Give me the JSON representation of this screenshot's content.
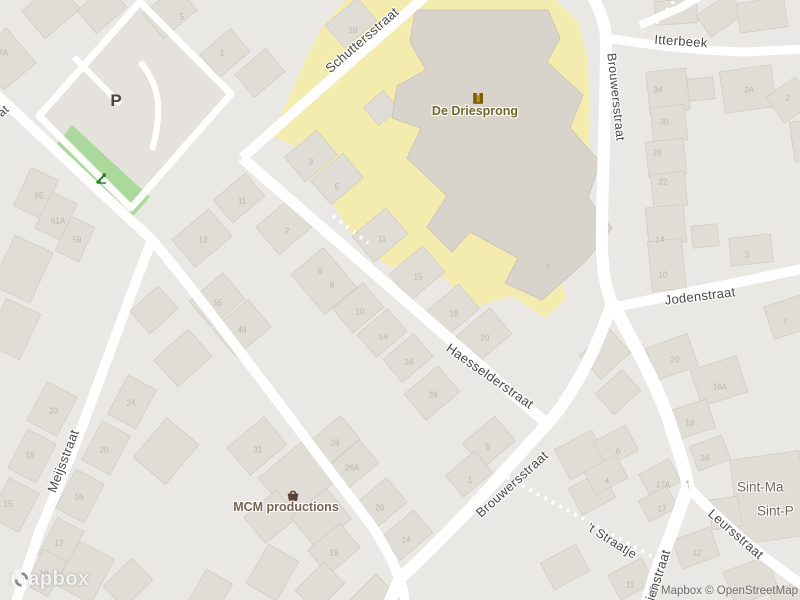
{
  "map": {
    "street_labels": [
      {
        "text": "Schuttersstraat",
        "x": 362,
        "y": 40,
        "rot": -41,
        "size": 13
      },
      {
        "text": "Itterbeek",
        "x": 681,
        "y": 41,
        "rot": 4,
        "size": 13
      },
      {
        "text": "Brouwersstraat",
        "x": 616,
        "y": 97,
        "rot": 84,
        "size": 12.5
      },
      {
        "text": "Jodenstraat",
        "x": 700,
        "y": 296,
        "rot": -7,
        "size": 13
      },
      {
        "text": "Haesselderstraat",
        "x": 490,
        "y": 376,
        "rot": 35,
        "size": 13
      },
      {
        "text": "Meijsstraat",
        "x": 63,
        "y": 461,
        "rot": -69,
        "size": 13
      },
      {
        "text": "Brouwersstraat",
        "x": 512,
        "y": 484,
        "rot": -42,
        "size": 13
      },
      {
        "text": "'t Straatje",
        "x": 612,
        "y": 541,
        "rot": 32,
        "size": 12.5
      },
      {
        "text": "Leursstraat",
        "x": 736,
        "y": 534,
        "rot": 41,
        "size": 13
      },
      {
        "text": "ienstraat",
        "x": 658,
        "y": 575,
        "rot": -72,
        "size": 13
      },
      {
        "text": "at",
        "x": 3,
        "y": 111,
        "rot": -43,
        "size": 12
      }
    ],
    "place_labels": [
      {
        "text": "Sint-Ma",
        "x": 737,
        "y": 487
      },
      {
        "text": "Sint-P",
        "x": 757,
        "y": 511
      }
    ],
    "pois": {
      "driesprong": {
        "name": "De Driesprong",
        "label_x": 475,
        "label_y": 111,
        "icon": "school-icon",
        "icon_x": 472,
        "icon_y": 92
      },
      "mcm": {
        "name": "MCM productions",
        "label_x": 286,
        "label_y": 507,
        "icon": "shopping-basket-icon",
        "icon_x": 286,
        "icon_y": 489
      },
      "parking": {
        "label": "P",
        "x": 116,
        "y": 101
      },
      "playground": {
        "icon": "playground-icon",
        "x": 95,
        "y": 172
      }
    },
    "oneway": {
      "glyph": "↑",
      "x": 688,
      "y": 484
    },
    "house_numbers": [
      {
        "t": "5",
        "x": 182,
        "y": 17
      },
      {
        "t": "1",
        "x": 222,
        "y": 53
      },
      {
        "t": "7A",
        "x": 3,
        "y": 53
      },
      {
        "t": "10",
        "x": 353,
        "y": 30
      },
      {
        "t": "3",
        "x": 311,
        "y": 162
      },
      {
        "t": "5",
        "x": 337,
        "y": 187
      },
      {
        "t": "2",
        "x": 287,
        "y": 231
      },
      {
        "t": "11",
        "x": 242,
        "y": 201
      },
      {
        "t": "13",
        "x": 203,
        "y": 240
      },
      {
        "t": "65",
        "x": 39,
        "y": 196
      },
      {
        "t": "61A",
        "x": 58,
        "y": 221
      },
      {
        "t": "59",
        "x": 77,
        "y": 240
      },
      {
        "t": "11",
        "x": 382,
        "y": 239
      },
      {
        "t": "15",
        "x": 418,
        "y": 277
      },
      {
        "t": "6",
        "x": 320,
        "y": 271
      },
      {
        "t": "8",
        "x": 332,
        "y": 285
      },
      {
        "t": "10",
        "x": 360,
        "y": 312
      },
      {
        "t": "14",
        "x": 383,
        "y": 337
      },
      {
        "t": "16",
        "x": 409,
        "y": 362
      },
      {
        "t": "20",
        "x": 485,
        "y": 338
      },
      {
        "t": "19",
        "x": 454,
        "y": 314
      },
      {
        "t": "39",
        "x": 433,
        "y": 395
      },
      {
        "t": "55",
        "x": 218,
        "y": 303
      },
      {
        "t": "49",
        "x": 242,
        "y": 330
      },
      {
        "t": "23",
        "x": 54,
        "y": 411
      },
      {
        "t": "19",
        "x": 30,
        "y": 455
      },
      {
        "t": "15",
        "x": 8,
        "y": 504
      },
      {
        "t": "24",
        "x": 131,
        "y": 403
      },
      {
        "t": "20",
        "x": 104,
        "y": 450
      },
      {
        "t": "16",
        "x": 79,
        "y": 497
      },
      {
        "t": "12",
        "x": 59,
        "y": 543
      },
      {
        "t": "10",
        "x": 44,
        "y": 574
      },
      {
        "t": "31",
        "x": 258,
        "y": 450
      },
      {
        "t": "28",
        "x": 335,
        "y": 443
      },
      {
        "t": "26A",
        "x": 352,
        "y": 468
      },
      {
        "t": "20",
        "x": 380,
        "y": 508
      },
      {
        "t": "14",
        "x": 406,
        "y": 540
      },
      {
        "t": "19",
        "x": 334,
        "y": 553
      },
      {
        "t": "5",
        "x": 488,
        "y": 447
      },
      {
        "t": "1",
        "x": 470,
        "y": 480
      },
      {
        "t": "34",
        "x": 658,
        "y": 90
      },
      {
        "t": "30",
        "x": 664,
        "y": 122
      },
      {
        "t": "26",
        "x": 657,
        "y": 153
      },
      {
        "t": "22",
        "x": 663,
        "y": 182
      },
      {
        "t": "14",
        "x": 660,
        "y": 240
      },
      {
        "t": "2A",
        "x": 749,
        "y": 90
      },
      {
        "t": "2",
        "x": 788,
        "y": 98
      },
      {
        "t": "10",
        "x": 663,
        "y": 275
      },
      {
        "t": "3",
        "x": 747,
        "y": 255
      },
      {
        "t": "20",
        "x": 675,
        "y": 360
      },
      {
        "t": "16A",
        "x": 720,
        "y": 387
      },
      {
        "t": "18",
        "x": 690,
        "y": 423
      },
      {
        "t": "7",
        "x": 785,
        "y": 322
      },
      {
        "t": "6",
        "x": 618,
        "y": 452
      },
      {
        "t": "4",
        "x": 607,
        "y": 481
      },
      {
        "t": "17A",
        "x": 663,
        "y": 485
      },
      {
        "t": "17",
        "x": 662,
        "y": 509
      },
      {
        "t": "16",
        "x": 705,
        "y": 458
      },
      {
        "t": "12",
        "x": 697,
        "y": 553
      },
      {
        "t": "11",
        "x": 630,
        "y": 585
      },
      {
        "t": "3",
        "x": 548,
        "y": 267
      }
    ],
    "attribution": {
      "logo_text": "mapbox",
      "copyright": "© Mapbox © OpenStreetMap"
    },
    "colors": {
      "background": "#eae8e4",
      "road": "#ffffff",
      "building": "#e0dcd6",
      "building_outline": "#cfc9c1",
      "school_yard": "#f4ecae",
      "school_building": "#d8d3cb",
      "playground_green": "#abd89b",
      "street_label": "#474747",
      "house_number": "#b5b0a8",
      "poi_school": "#70672b",
      "poi_shop": "#7a6452",
      "place_label": "#6c6862",
      "parking": "#4f473e",
      "attribution": "#6b6b6b"
    }
  }
}
